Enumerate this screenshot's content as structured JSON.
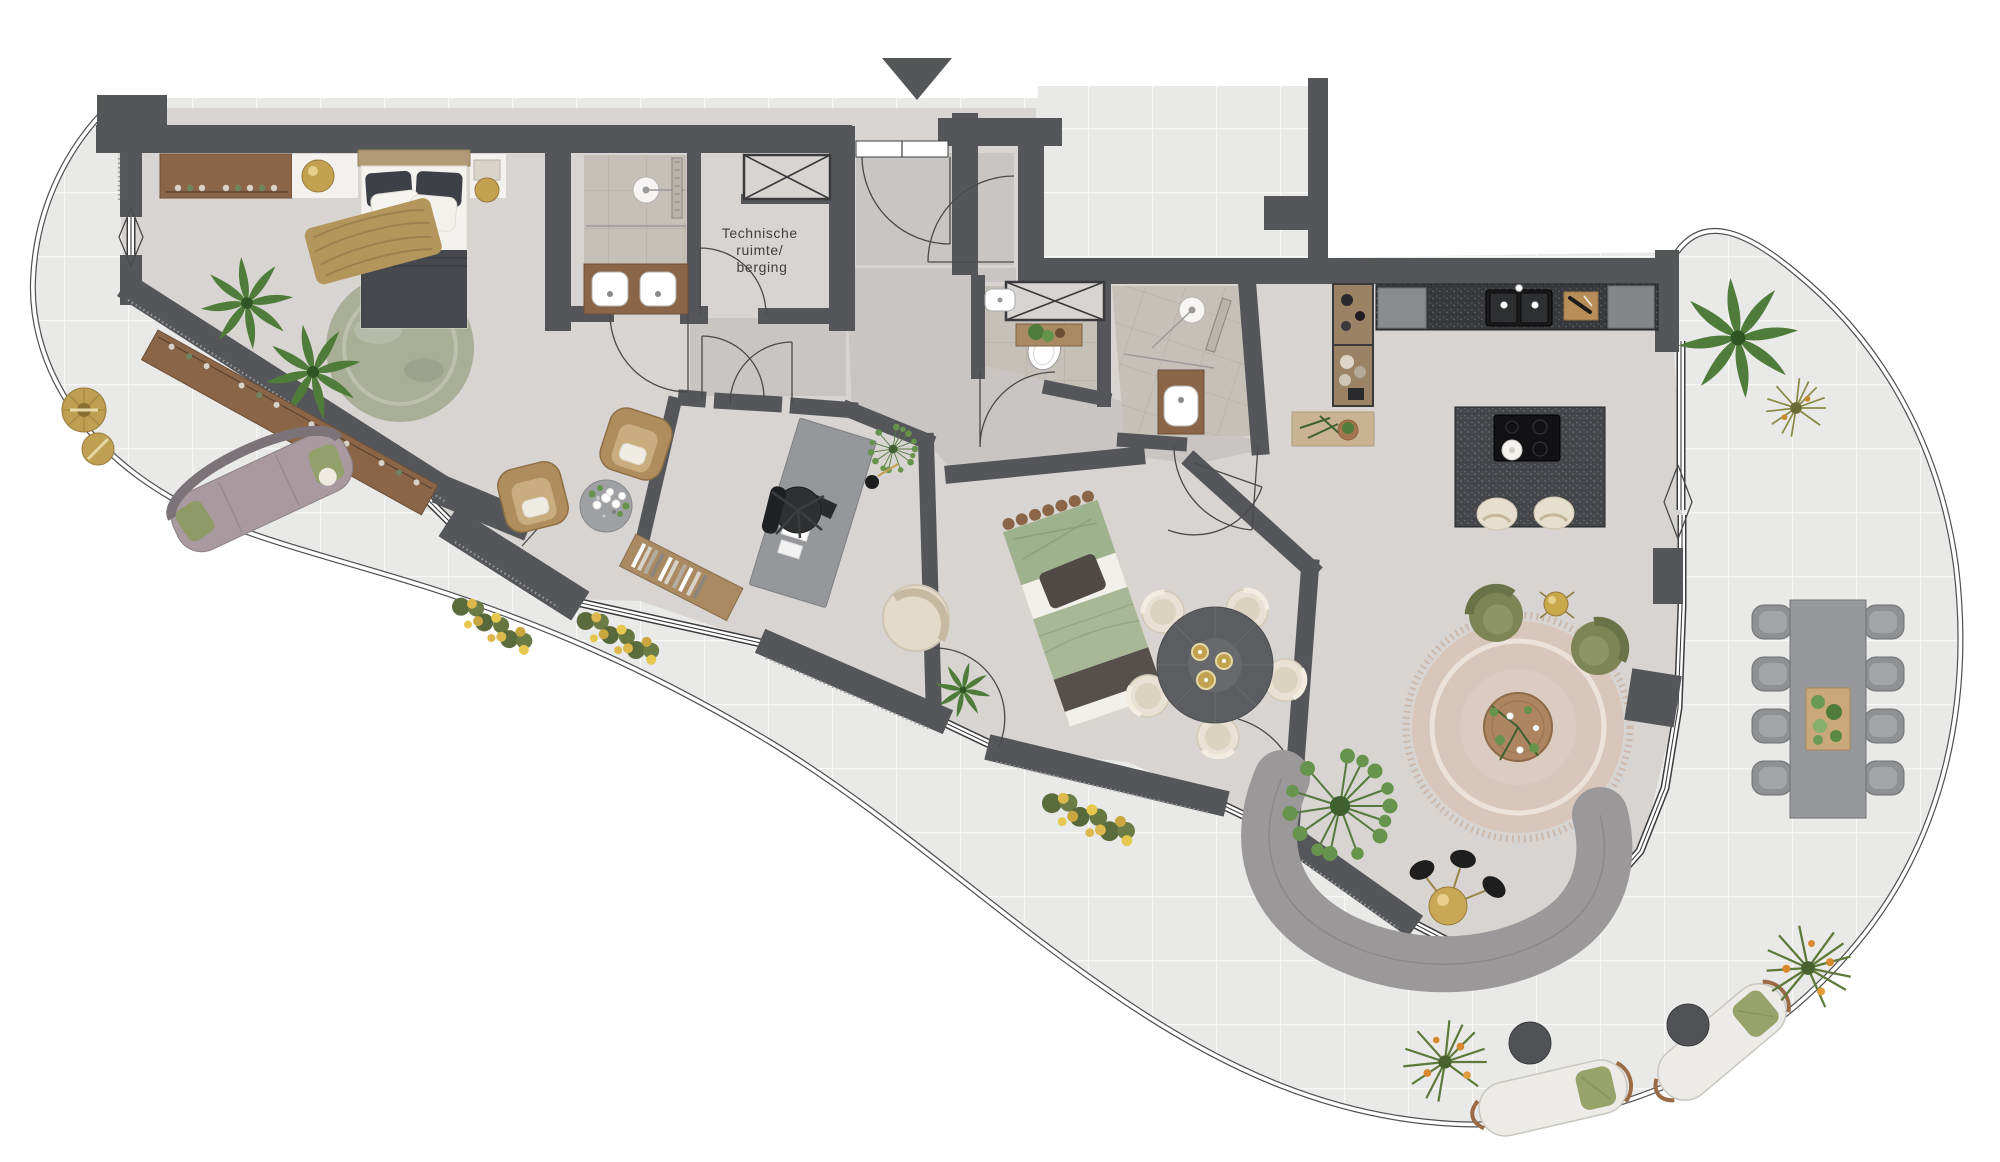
{
  "page": {
    "type": "residential-floor-plan",
    "background": "#ffffff"
  },
  "labels": {
    "technical_room_lines": [
      "Technische",
      "ruimte/",
      "berging"
    ]
  },
  "icons": {
    "entrance_marker": "triangle-down"
  },
  "rooms": [
    "terrace",
    "master-bedroom",
    "ensuite-bathroom",
    "technical-room",
    "entrance-hall",
    "toilet",
    "bathroom",
    "home-office",
    "bedroom",
    "kitchen",
    "living-dining"
  ],
  "colors": {
    "wall": "#55565a",
    "floor": "#d7d4d1",
    "terrace_tile": "#e9e9e8",
    "tile_grout": "#f8f8f7",
    "bath_tile": "#c6c1b8",
    "bath_grout": "#b2aca2",
    "wood": "#8a6547",
    "wood_light": "#a98a62",
    "counter_dark": "#38393c",
    "island_dark": "#45464a",
    "gold": "#c2a14f",
    "plant": "#4f7c3a",
    "plant_light": "#67944c",
    "olive": "#7d8455",
    "rug_green": "#a9af97",
    "rug_pink": "#d9c6bb",
    "sofa_gray": "#9b989a",
    "outdoor_sofa": "#a89a9e",
    "cream": "#e9e1d3",
    "bed_dark": "#46484e",
    "bedding_green": "#a8b896",
    "window_line": "#3c3c3e",
    "door_line": "#4a4a4b",
    "label": "#3f3f3f"
  }
}
